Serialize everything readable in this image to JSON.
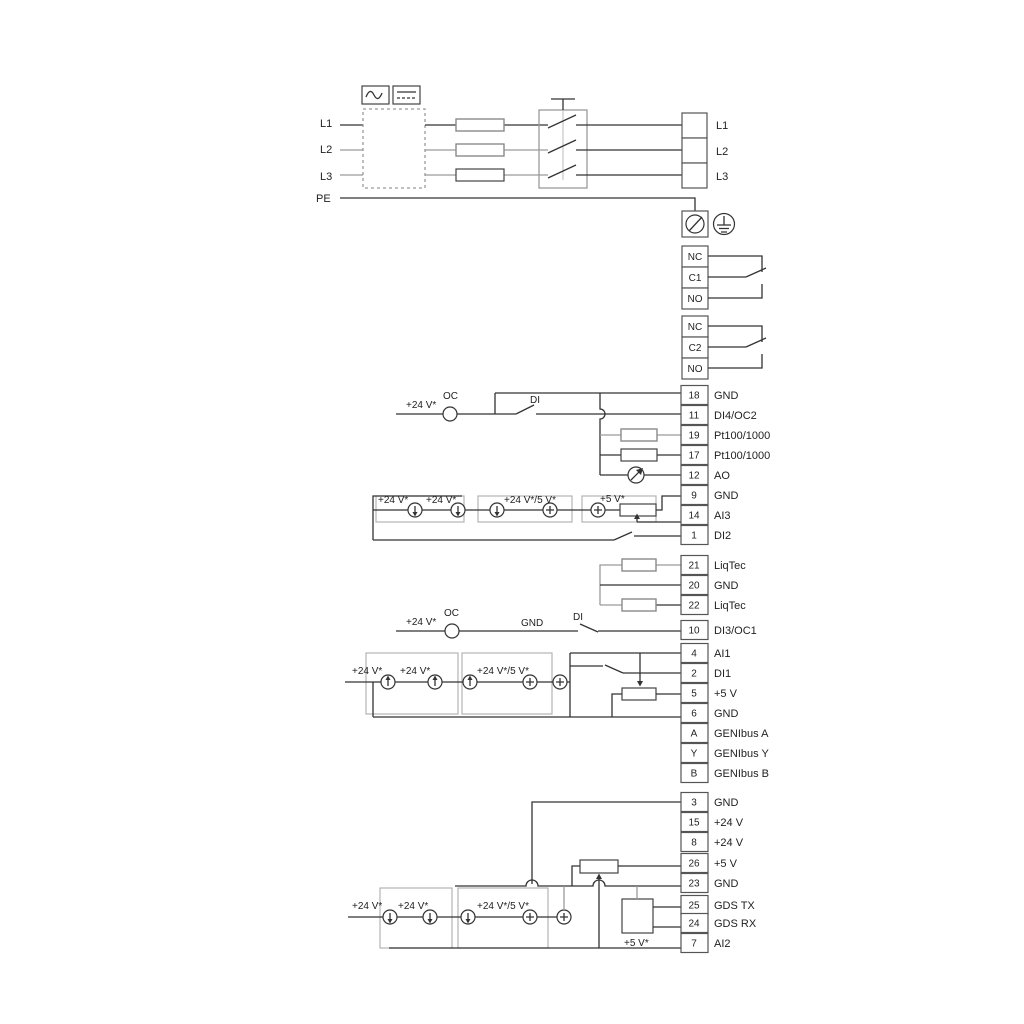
{
  "colors": {
    "wire": "#333333",
    "gray_wire": "#9a9a9a",
    "group_box": "#b3b3b3",
    "text": "#1f1f1f",
    "background": "#ffffff"
  },
  "power": {
    "inputs": [
      "L1",
      "L2",
      "L3",
      "PE"
    ],
    "outputs": [
      "L1",
      "L2",
      "L3"
    ],
    "icons": {
      "ac_icon": "sine-wave",
      "dc_icon": "solid-over-dashed-line",
      "screen_icon": "circle-slash",
      "earth_icon": "earth-ground"
    }
  },
  "relay1": {
    "c0": "NC",
    "c1": "C1",
    "c2": "NO"
  },
  "relay2": {
    "c0": "NC",
    "c1": "C2",
    "c2": "NO"
  },
  "block1": [
    {
      "no": "18",
      "label": "GND"
    },
    {
      "no": "11",
      "label": "DI4/OC2"
    },
    {
      "no": "19",
      "label": "Pt100/1000"
    },
    {
      "no": "17",
      "label": "Pt100/1000"
    },
    {
      "no": "12",
      "label": "AO"
    },
    {
      "no": "9",
      "label": "GND"
    },
    {
      "no": "14",
      "label": "AI3"
    },
    {
      "no": "1",
      "label": "DI2"
    }
  ],
  "liqtec": [
    {
      "no": "21",
      "label": "LiqTec"
    },
    {
      "no": "20",
      "label": "GND"
    },
    {
      "no": "22",
      "label": "LiqTec"
    }
  ],
  "block2": [
    {
      "no": "10",
      "label": "DI3/OC1"
    },
    {
      "no": "4",
      "label": "AI1"
    },
    {
      "no": "2",
      "label": "DI1"
    },
    {
      "no": "5",
      "label": "+5 V"
    },
    {
      "no": "6",
      "label": "GND"
    },
    {
      "no": "A",
      "label": "GENIbus A"
    },
    {
      "no": "Y",
      "label": "GENIbus Y"
    },
    {
      "no": "B",
      "label": "GENIbus B"
    }
  ],
  "block3": [
    {
      "no": "3",
      "label": "GND"
    },
    {
      "no": "15",
      "label": "+24 V"
    },
    {
      "no": "8",
      "label": "+24 V"
    },
    {
      "no": "26",
      "label": "+5 V"
    },
    {
      "no": "23",
      "label": "GND"
    },
    {
      "no": "25",
      "label": "GDS TX"
    },
    {
      "no": "24",
      "label": "GDS RX"
    },
    {
      "no": "7",
      "label": "AI2"
    }
  ],
  "ann": {
    "oc": "OC",
    "di": "DI",
    "gnd": "GND",
    "v24": "+24 V*",
    "v24v5": "+24 V*/5 V*",
    "v5": "+5 V*"
  }
}
